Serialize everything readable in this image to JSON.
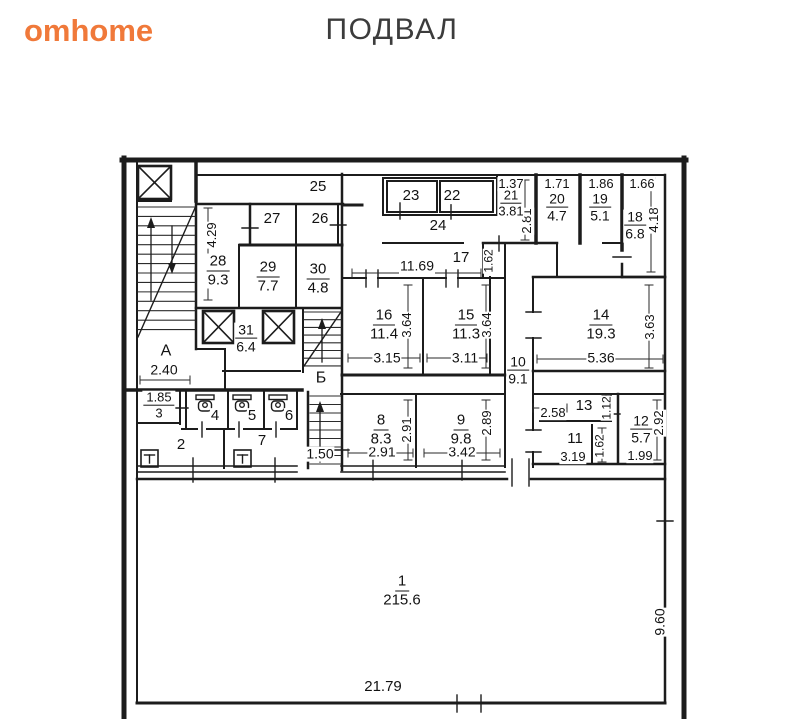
{
  "header": {
    "logo": "omhome",
    "logo_color": "#f0793a",
    "title": "ПОДВАЛ",
    "title_color": "#3c3c3c"
  },
  "plan": {
    "wall_color": "#1c1c1c",
    "labels": [
      {
        "text": "25",
        "x": 318,
        "y": 187,
        "fs": 15
      },
      {
        "text": "27",
        "x": 272,
        "y": 219,
        "fs": 15
      },
      {
        "text": "26",
        "x": 320,
        "y": 219,
        "fs": 15
      },
      {
        "text": "23",
        "x": 411,
        "y": 196,
        "fs": 15
      },
      {
        "text": "22",
        "x": 452,
        "y": 196,
        "fs": 15
      },
      {
        "text": "24",
        "x": 438,
        "y": 226,
        "fs": 15
      },
      {
        "text": "1.37",
        "x": 511,
        "y": 184,
        "fs": 13
      },
      {
        "text": "2.81",
        "x": 527,
        "y": 221,
        "fs": 13,
        "rot": 1
      },
      {
        "text": "1.71",
        "x": 557,
        "y": 184,
        "fs": 13
      },
      {
        "text": "1.86",
        "x": 601,
        "y": 184,
        "fs": 13
      },
      {
        "text": "1.66",
        "x": 642,
        "y": 184,
        "fs": 13
      },
      {
        "text": "4.18",
        "x": 654,
        "y": 220,
        "fs": 13,
        "rot": 1
      },
      {
        "text": "4.29",
        "x": 212,
        "y": 235,
        "fs": 13,
        "rot": 1
      },
      {
        "text": "11.69",
        "x": 417,
        "y": 266,
        "fs": 14
      },
      {
        "text": "17",
        "x": 461,
        "y": 258,
        "fs": 15
      },
      {
        "text": "1.62",
        "x": 489,
        "y": 261,
        "fs": 12,
        "rot": 1
      },
      {
        "text": "3.64",
        "x": 407,
        "y": 325,
        "fs": 13,
        "rot": 1
      },
      {
        "text": "3.15",
        "x": 387,
        "y": 358,
        "fs": 14
      },
      {
        "text": "3.64",
        "x": 487,
        "y": 325,
        "fs": 13,
        "rot": 1
      },
      {
        "text": "3.11",
        "x": 465,
        "y": 358,
        "fs": 14
      },
      {
        "text": "3.63",
        "x": 650,
        "y": 327,
        "fs": 13,
        "rot": 1
      },
      {
        "text": "5.36",
        "x": 601,
        "y": 358,
        "fs": 14
      },
      {
        "text": "А",
        "x": 166,
        "y": 352,
        "fs": 16
      },
      {
        "text": "2.40",
        "x": 164,
        "y": 370,
        "fs": 14
      },
      {
        "text": "Б",
        "x": 321,
        "y": 379,
        "fs": 16
      },
      {
        "text": "4",
        "x": 215,
        "y": 416,
        "fs": 15
      },
      {
        "text": "5",
        "x": 252,
        "y": 416,
        "fs": 15
      },
      {
        "text": "6",
        "x": 289,
        "y": 416,
        "fs": 15
      },
      {
        "text": "2",
        "x": 181,
        "y": 445,
        "fs": 15
      },
      {
        "text": "7",
        "x": 262,
        "y": 441,
        "fs": 15
      },
      {
        "text": "1.50",
        "x": 320,
        "y": 454,
        "fs": 14
      },
      {
        "text": "2.91",
        "x": 407,
        "y": 430,
        "fs": 13,
        "rot": 1
      },
      {
        "text": "2.91",
        "x": 382,
        "y": 452,
        "fs": 14
      },
      {
        "text": "2.89",
        "x": 487,
        "y": 423,
        "fs": 13,
        "rot": 1
      },
      {
        "text": "3.42",
        "x": 462,
        "y": 452,
        "fs": 14
      },
      {
        "text": "2.58",
        "x": 553,
        "y": 413,
        "fs": 13
      },
      {
        "text": "13",
        "x": 584,
        "y": 406,
        "fs": 15
      },
      {
        "text": "1.12",
        "x": 607,
        "y": 408,
        "fs": 12,
        "rot": 1
      },
      {
        "text": "11",
        "x": 575,
        "y": 439,
        "fs": 15
      },
      {
        "text": "3.19",
        "x": 573,
        "y": 457,
        "fs": 13
      },
      {
        "text": "1.62",
        "x": 600,
        "y": 446,
        "fs": 12,
        "rot": 1
      },
      {
        "text": "2.92",
        "x": 659,
        "y": 423,
        "fs": 13,
        "rot": 1
      },
      {
        "text": "1.99",
        "x": 640,
        "y": 456,
        "fs": 13
      },
      {
        "text": "21.79",
        "x": 383,
        "y": 687,
        "fs": 15
      },
      {
        "text": "9.60",
        "x": 660,
        "y": 622,
        "fs": 14,
        "rot": 1
      }
    ],
    "fractions": [
      {
        "num": "21",
        "den": "3.81",
        "x": 511,
        "y": 204,
        "fs": 13
      },
      {
        "num": "20",
        "den": "4.7",
        "x": 557,
        "y": 208,
        "fs": 14
      },
      {
        "num": "19",
        "den": "5.1",
        "x": 600,
        "y": 208,
        "fs": 14
      },
      {
        "num": "18",
        "den": "6.8",
        "x": 635,
        "y": 226,
        "fs": 14
      },
      {
        "num": "28",
        "den": "9.3",
        "x": 218,
        "y": 271,
        "fs": 15
      },
      {
        "num": "29",
        "den": "7.7",
        "x": 268,
        "y": 277,
        "fs": 15
      },
      {
        "num": "30",
        "den": "4.8",
        "x": 318,
        "y": 279,
        "fs": 15
      },
      {
        "num": "16",
        "den": "11.4",
        "x": 384,
        "y": 325,
        "fs": 15
      },
      {
        "num": "15",
        "den": "11.3",
        "x": 466,
        "y": 325,
        "fs": 15
      },
      {
        "num": "10",
        "den": "9.1",
        "x": 518,
        "y": 371,
        "fs": 14
      },
      {
        "num": "14",
        "den": "19.3",
        "x": 601,
        "y": 325,
        "fs": 15
      },
      {
        "num": "31",
        "den": "6.4",
        "x": 246,
        "y": 339,
        "fs": 14
      },
      {
        "num": "1.85",
        "den": "3",
        "x": 159,
        "y": 406,
        "fs": 13
      },
      {
        "num": "8",
        "den": "8.3",
        "x": 381,
        "y": 430,
        "fs": 15
      },
      {
        "num": "9",
        "den": "9.8",
        "x": 461,
        "y": 430,
        "fs": 15
      },
      {
        "num": "12",
        "den": "5.7",
        "x": 641,
        "y": 430,
        "fs": 14
      },
      {
        "num": "1",
        "den": "215.6",
        "x": 402,
        "y": 591,
        "fs": 15
      }
    ],
    "icons": {
      "elevator_shafts": [
        {
          "icon": "elevator-shaft-icon",
          "x": 138,
          "y": 166,
          "w": 33,
          "h": 33
        },
        {
          "icon": "elevator-shaft-icon",
          "x": 203,
          "y": 311,
          "w": 31,
          "h": 32
        },
        {
          "icon": "elevator-shaft-icon",
          "x": 263,
          "y": 311,
          "w": 31,
          "h": 32
        }
      ],
      "toilets": [
        {
          "icon": "toilet-icon",
          "x": 196,
          "y": 395
        },
        {
          "icon": "toilet-icon",
          "x": 233,
          "y": 395
        },
        {
          "icon": "toilet-icon",
          "x": 269,
          "y": 395
        }
      ],
      "sinks": [
        {
          "icon": "sink-icon",
          "x": 141,
          "y": 450
        },
        {
          "icon": "sink-icon",
          "x": 234,
          "y": 450
        }
      ],
      "stairwells": [
        "А",
        "Б"
      ]
    }
  }
}
